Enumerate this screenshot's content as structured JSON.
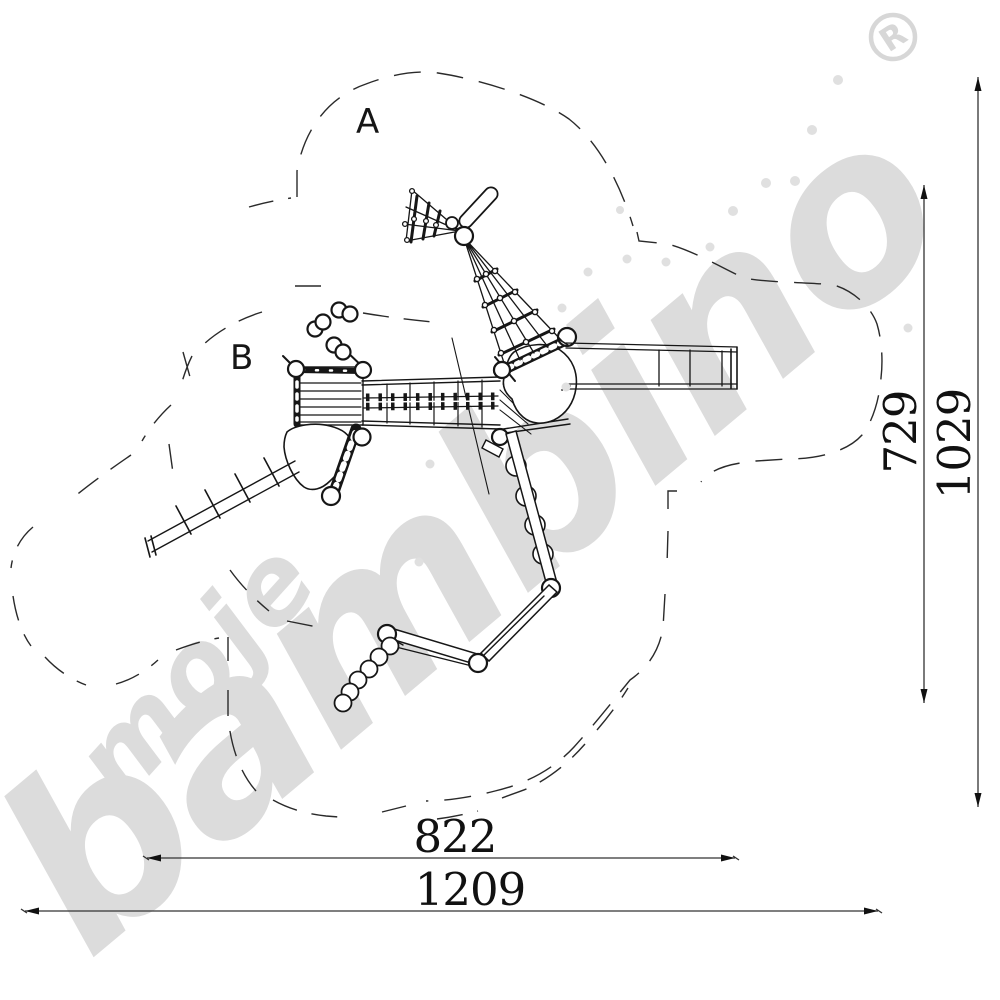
{
  "zone_labels": {
    "a": "A",
    "b": "B"
  },
  "dimensions": {
    "inner_width": "822",
    "outer_width": "1209",
    "inner_height": "729",
    "outer_height": "1029"
  },
  "watermark": {
    "word_small": "moje",
    "word_large": "bambino",
    "registered_mark": "R"
  },
  "colors": {
    "drawing": "#161616",
    "dimension": "#111111",
    "watermark": "#dcdcdc",
    "background": "#ffffff"
  }
}
